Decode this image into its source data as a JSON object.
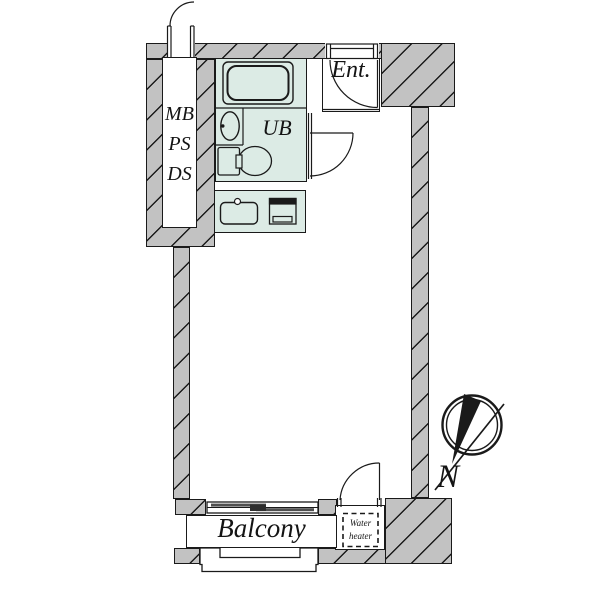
{
  "plan": {
    "rooms": {
      "shaft_label_lines": [
        "MB",
        "PS",
        "DS"
      ],
      "unit_bath_label": "UB",
      "entrance_label": "Ent.",
      "balcony_label": "Balcony",
      "water_heater_label_lines": [
        "Water",
        "heater"
      ],
      "compass_label": "N"
    },
    "colors": {
      "wall_fill": "#c2c2c2",
      "wet_fill": "#dcebe5",
      "outline": "#1a1a1a",
      "glass": "#4f4f4f",
      "background": "#ffffff"
    }
  }
}
